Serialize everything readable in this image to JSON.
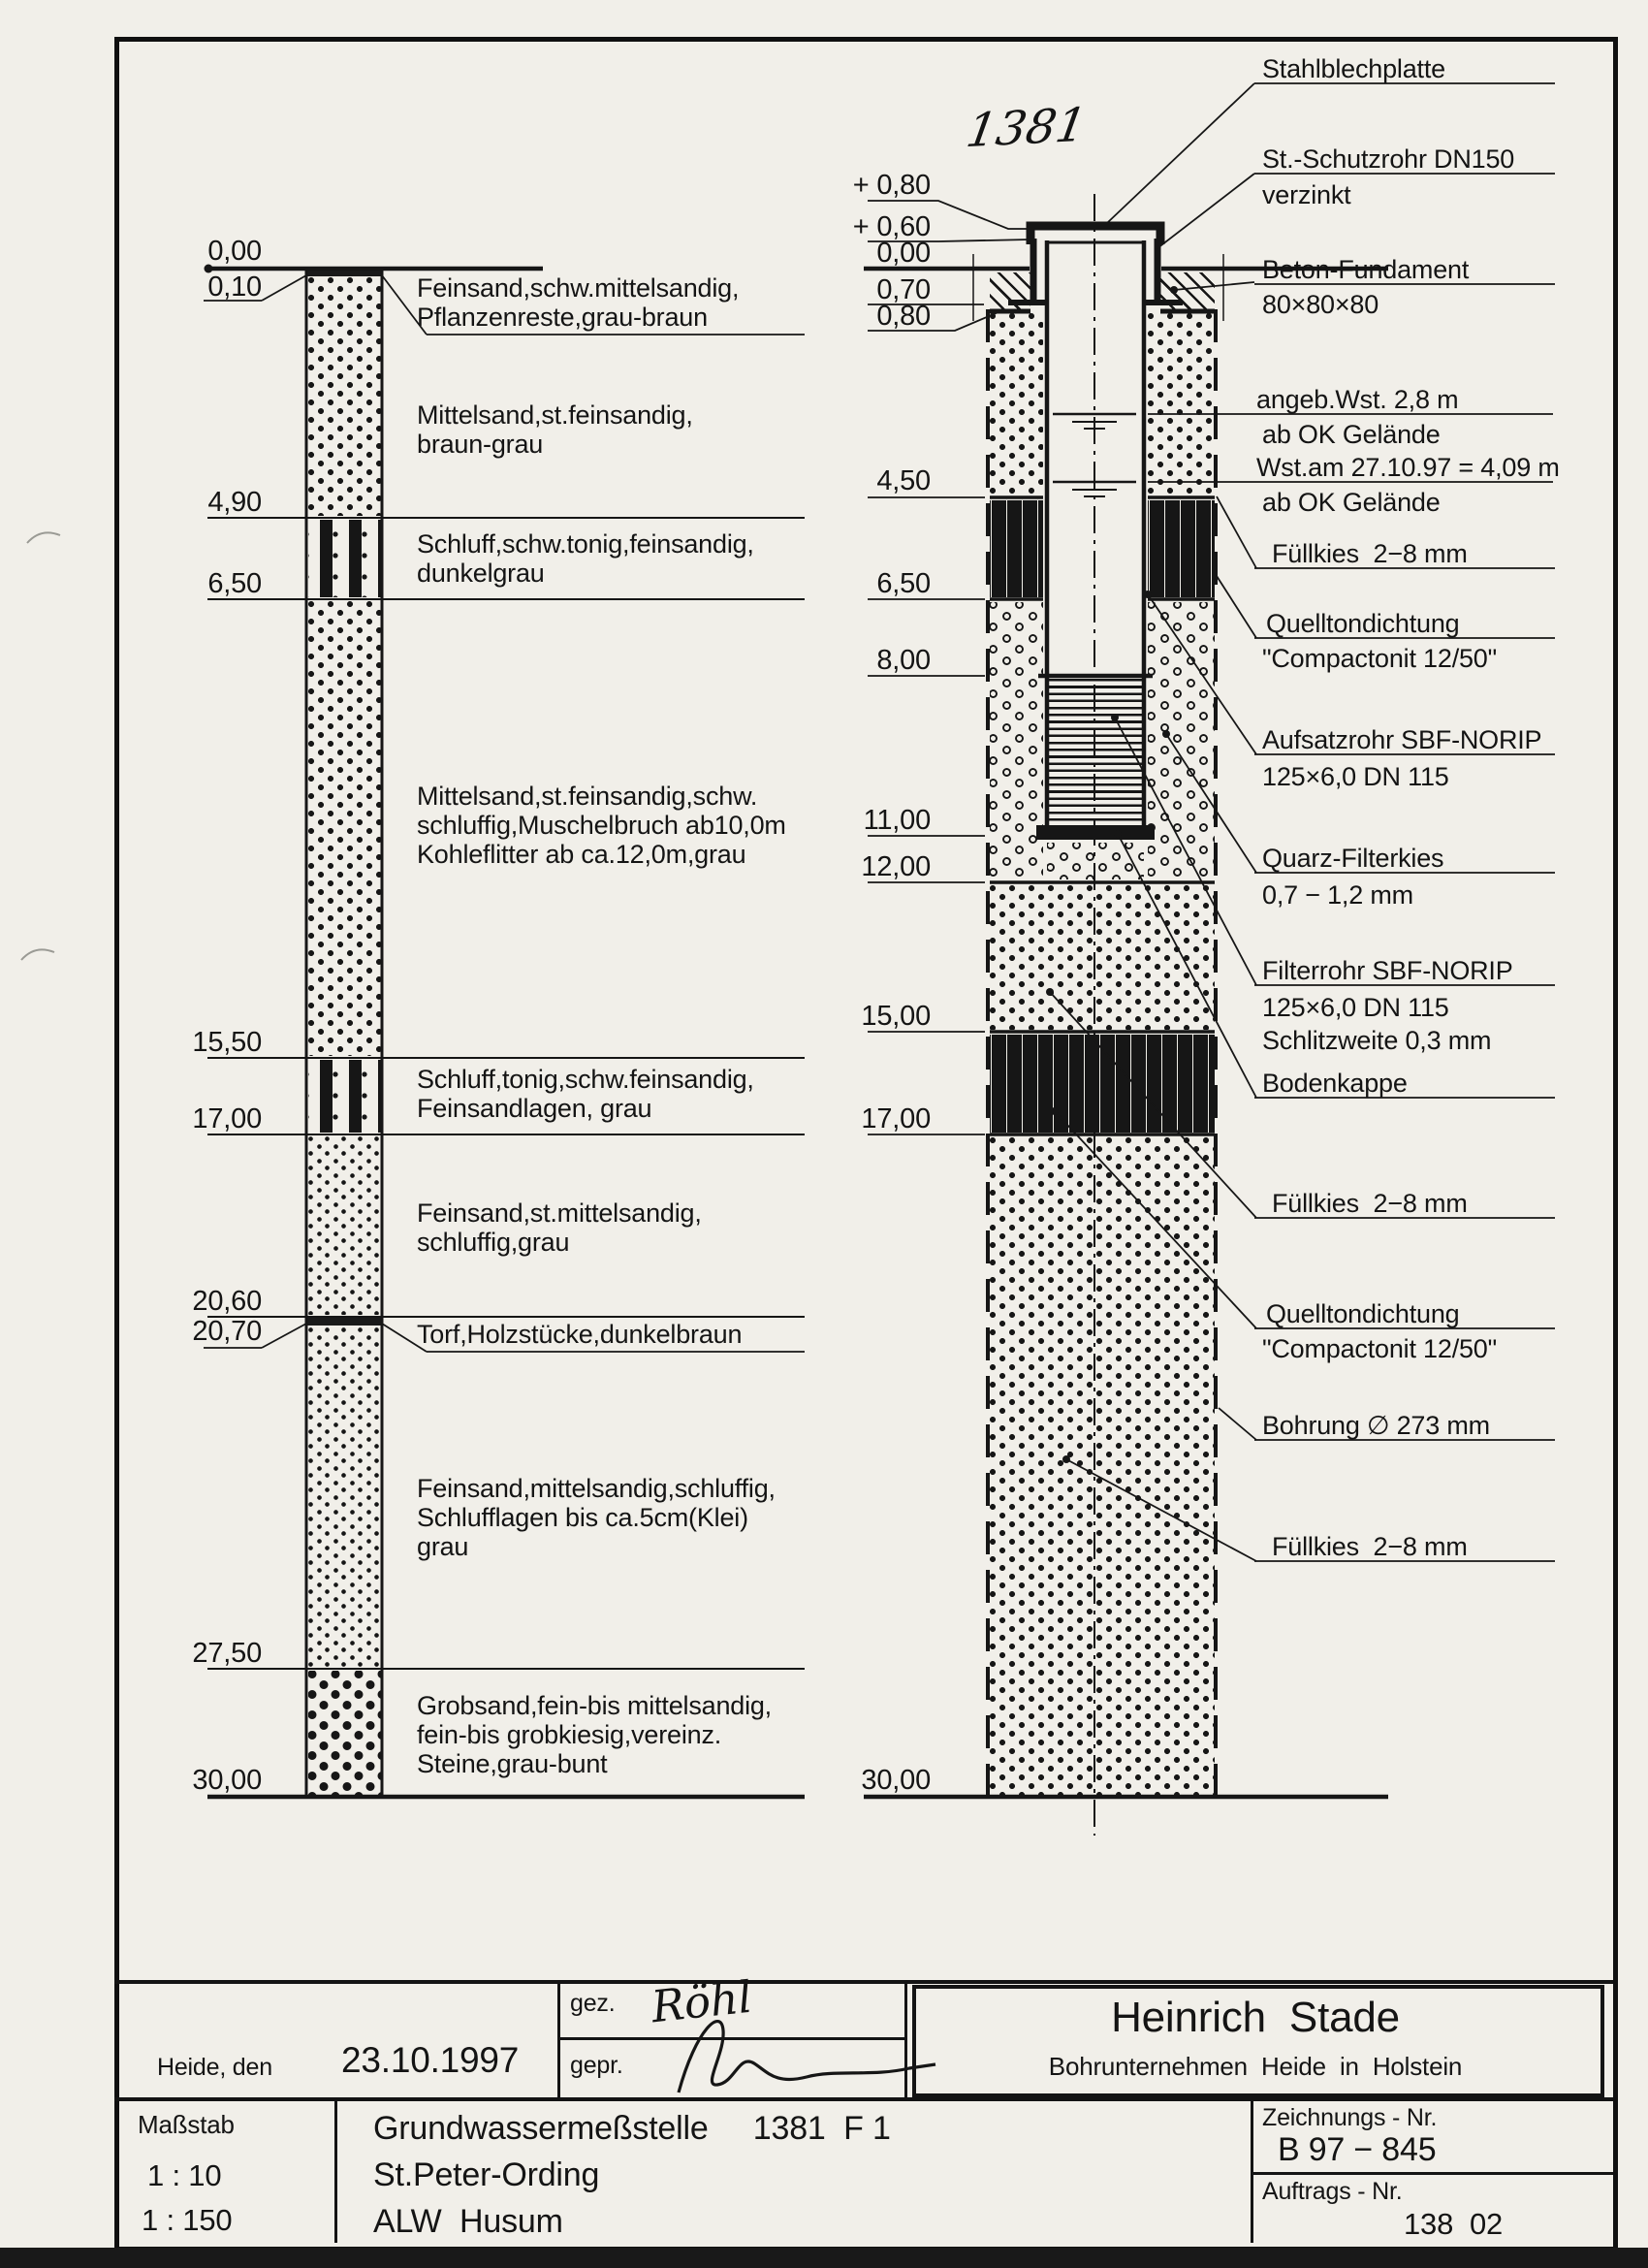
{
  "page": {
    "handwritten_number": "1381"
  },
  "colors": {
    "ink": "#161616",
    "paper": "#f1efe9"
  },
  "left_profile": {
    "depth_labels": [
      "0,00",
      "0,10",
      "4,90",
      "6,50",
      "15,50",
      "17,00",
      "20,60",
      "20,70",
      "27,50",
      "30,00"
    ],
    "layers": [
      {
        "desc": "Feinsand,schw.mittelsandig,\nPflanzenreste,grau-braun"
      },
      {
        "desc": "Mittelsand,st.feinsandig,\nbraun-grau"
      },
      {
        "desc": "Schluff,schw.tonig,feinsandig,\ndunkelgrau"
      },
      {
        "desc": "Mittelsand,st.feinsandig,schw.\nschluffig,Muschelbruch ab10,0m\nKohleflitter ab ca.12,0m,grau"
      },
      {
        "desc": "Schluff,tonig,schw.feinsandig,\nFeinsandlagen, grau"
      },
      {
        "desc": "Feinsand,st.mittelsandig,\nschluffig,grau"
      },
      {
        "desc": "Torf,Holzstücke,dunkelbraun"
      },
      {
        "desc": "Feinsand,mittelsandig,schluffig,\nSchlufflagen bis ca.5cm(Klei)\ngrau"
      },
      {
        "desc": "Grobsand,fein-bis mittelsandig,\nfein-bis grobkiesig,vereinz.\nSteine,grau-bunt"
      }
    ]
  },
  "well": {
    "levels": [
      "+ 0,80",
      "+ 0,60",
      "0,00",
      "0,70",
      "0,80",
      "4,50",
      "6,50",
      "8,00",
      "11,00",
      "12,00",
      "15,00",
      "17,00",
      "30,00"
    ],
    "annotations": {
      "stahlblechplatte": "Stahlblechplatte",
      "schutzrohr_1": "St.-Schutzrohr DN150",
      "schutzrohr_2": "verzinkt",
      "beton_1": "Beton-Fundament",
      "beton_2": "80×80×80",
      "wst1_1": "angeb.Wst. 2,8 m",
      "wst1_2": "ab OK Gelände",
      "wst2_1": "Wst.am 27.10.97 = 4,09 m",
      "wst2_2": "ab OK Gelände",
      "fuellkies1": "Füllkies  2−8 mm",
      "quellton1_1": "Quelltondichtung",
      "quellton1_2": "\"Compactonit 12/50\"",
      "aufsatzrohr_1": "Aufsatzrohr SBF-NORIP",
      "aufsatzrohr_2": "125×6,0 DN 115",
      "quarz_1": "Quarz-Filterkies",
      "quarz_2": "0,7 − 1,2 mm",
      "filterrohr_1": "Filterrohr SBF-NORIP",
      "filterrohr_2": "125×6,0 DN 115",
      "filterrohr_3": "Schlitzweite 0,3 mm",
      "bodenkappe": "Bodenkappe",
      "fuellkies2": "Füllkies  2−8 mm",
      "quellton2_1": "Quelltondichtung",
      "quellton2_2": "\"Compactonit 12/50\"",
      "bohrung": "Bohrung ∅ 273 mm",
      "fuellkies3": "Füllkies  2−8 mm"
    }
  },
  "title_block": {
    "place_label": "Heide, den",
    "date": "23.10.1997",
    "gez_label": "gez.",
    "gez_signature": "Röhl",
    "gepr_label": "gepr.",
    "company_name": "Heinrich  Stade",
    "company_sub": "Bohrunternehmen  Heide  in  Holstein",
    "masstab_label": "Maßstab",
    "scale1": "1 : 10",
    "scale2": "1 : 150",
    "project_line1": "Grundwassermeßstelle     1381  F 1",
    "project_line2": "St.Peter-Ording",
    "project_line3": "ALW  Husum",
    "zeichnungs_label": "Zeichnungs - Nr.",
    "zeichnungs_nr": "B 97 − 845",
    "auftrags_label": "Auftrags - Nr.",
    "auftrags_nr": "138  02"
  }
}
